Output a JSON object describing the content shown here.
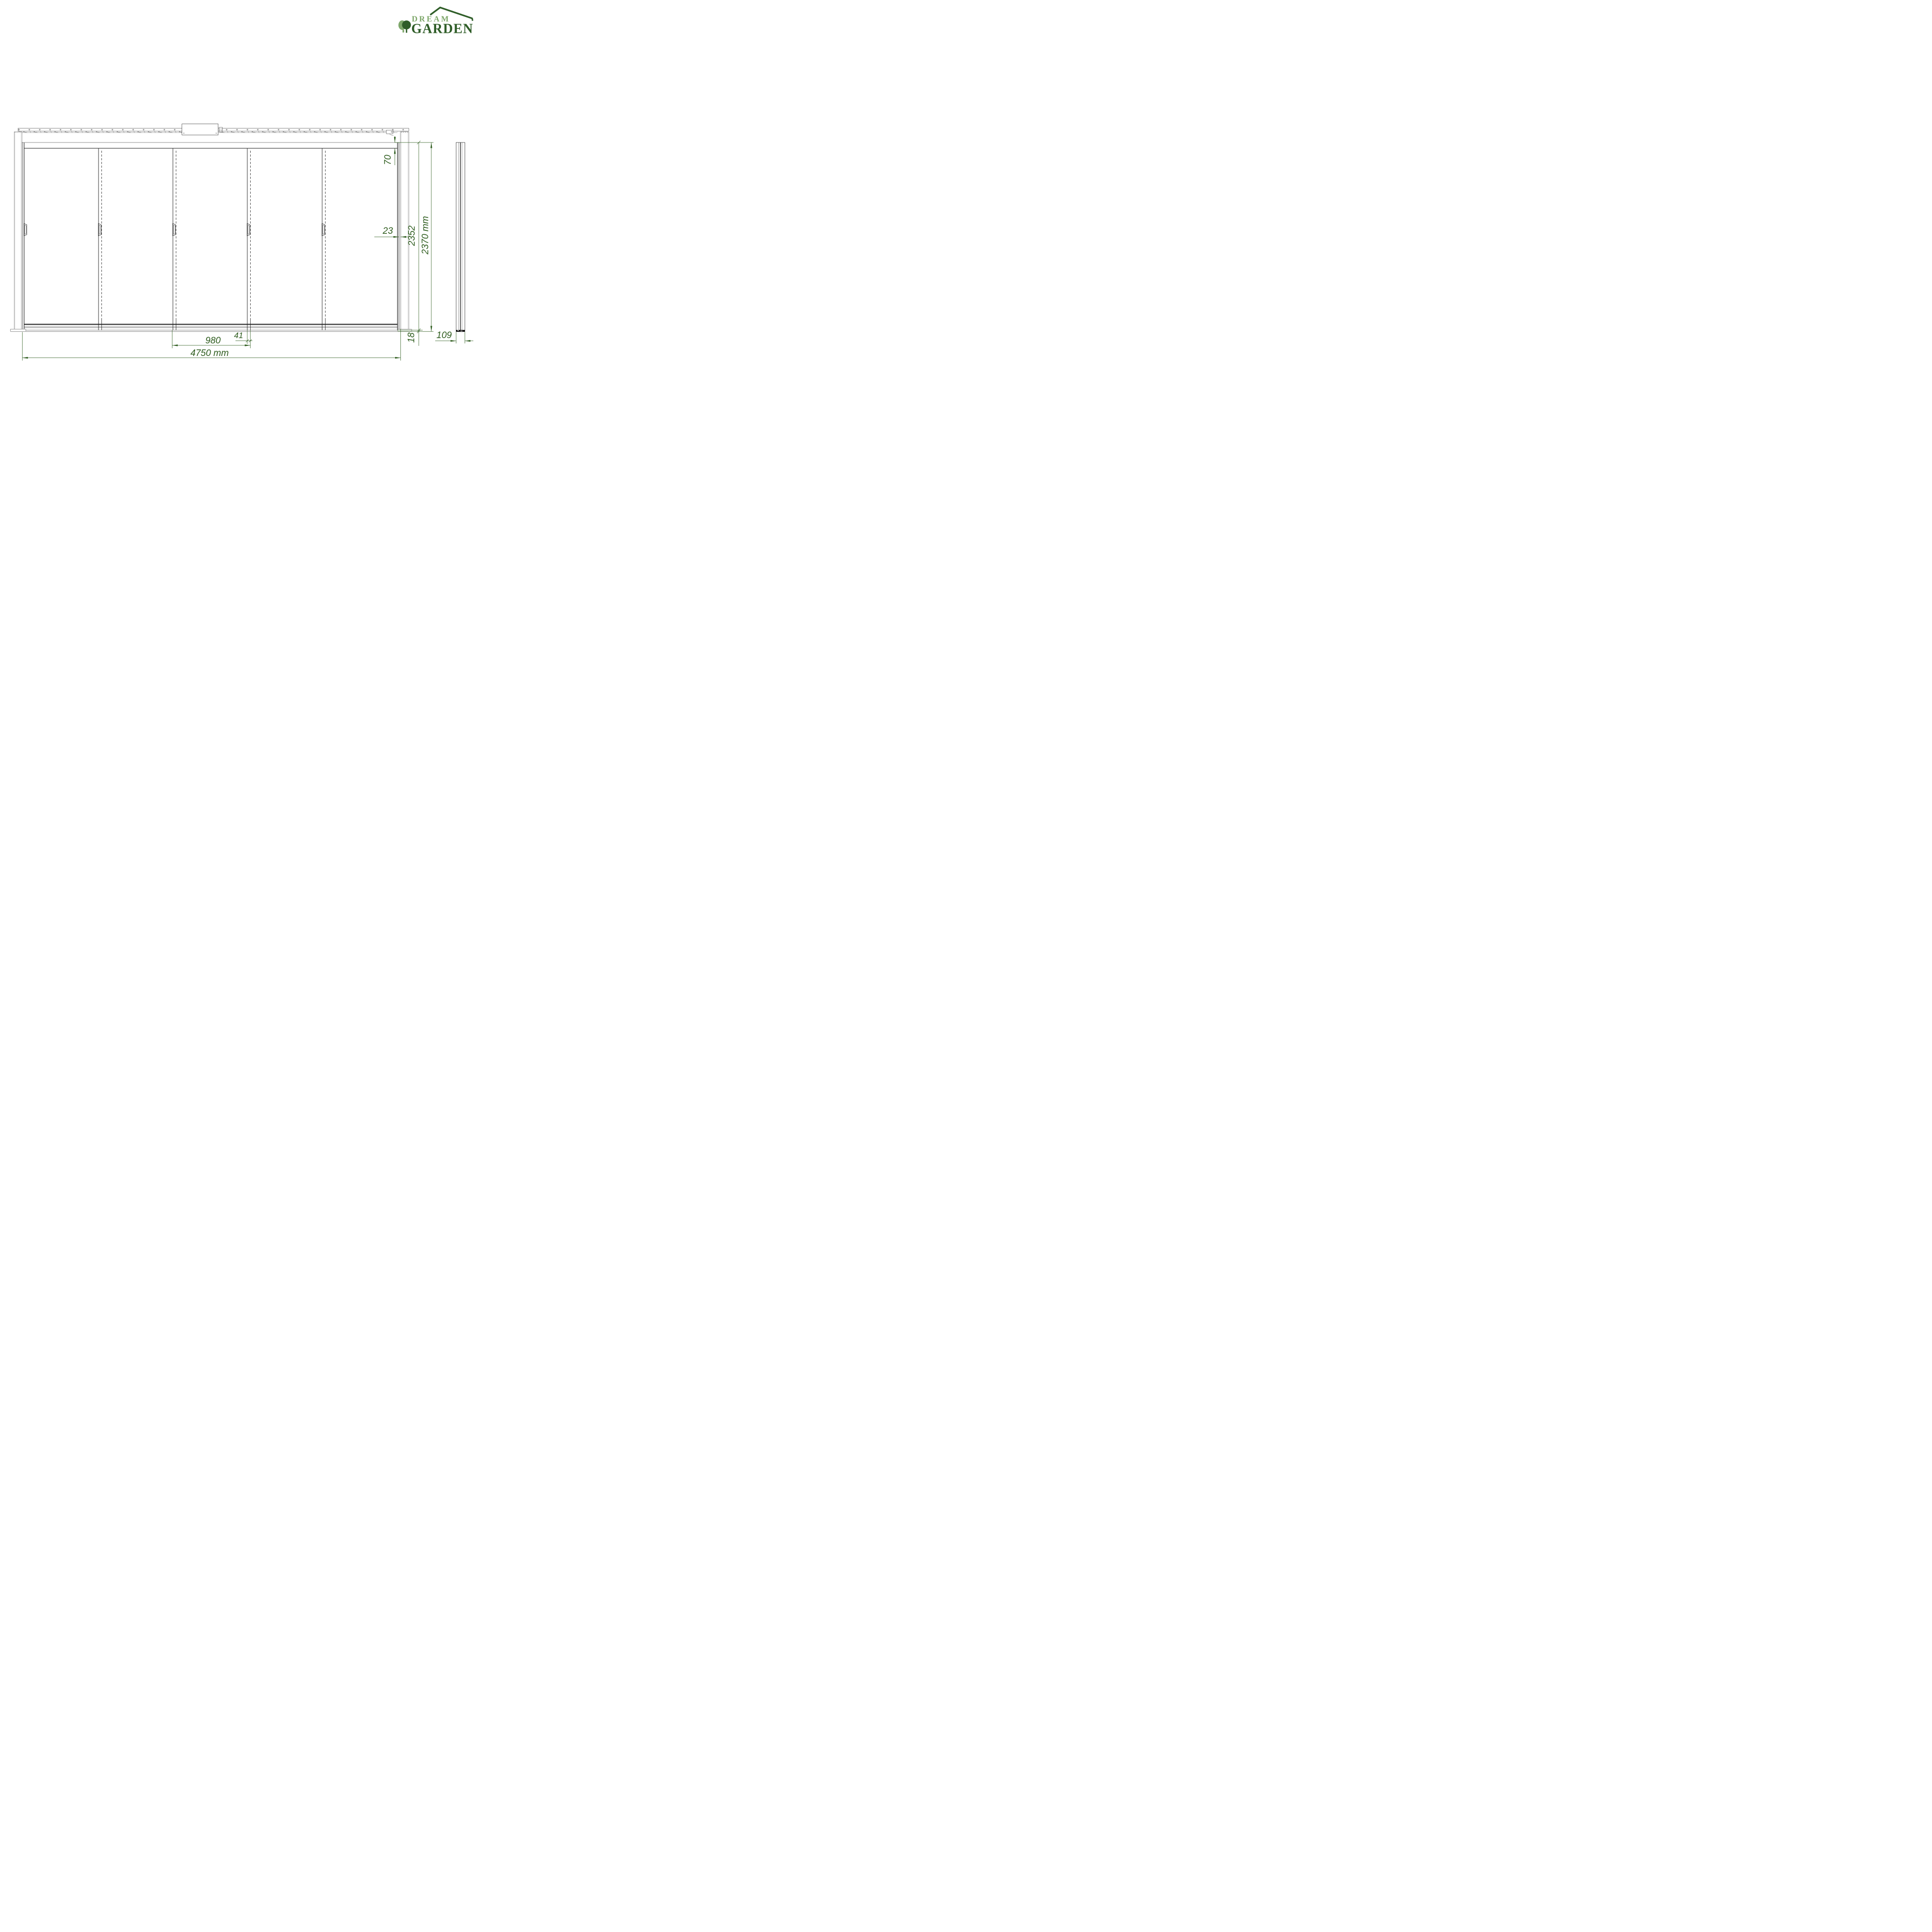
{
  "logo": {
    "brand_top": "DREAM",
    "brand_bottom": "GARDEN",
    "color_light": "#7ea76a",
    "color_dark": "#2f5d28"
  },
  "drawing": {
    "type": "sliding-glass-door elevation with side section",
    "panel_count": 5,
    "handle_count": 5,
    "line_color": "#1a1a1a",
    "dimension_color": "#2e5c1e",
    "dimensions": {
      "total_width": "4750 mm",
      "panel_width": "980",
      "panel_overlap": "41",
      "total_height": "2370 mm",
      "inner_height": "2352",
      "top_profile_height": "70",
      "side_gap": "23",
      "bottom_profile_height": "18",
      "section_depth": "109"
    }
  }
}
